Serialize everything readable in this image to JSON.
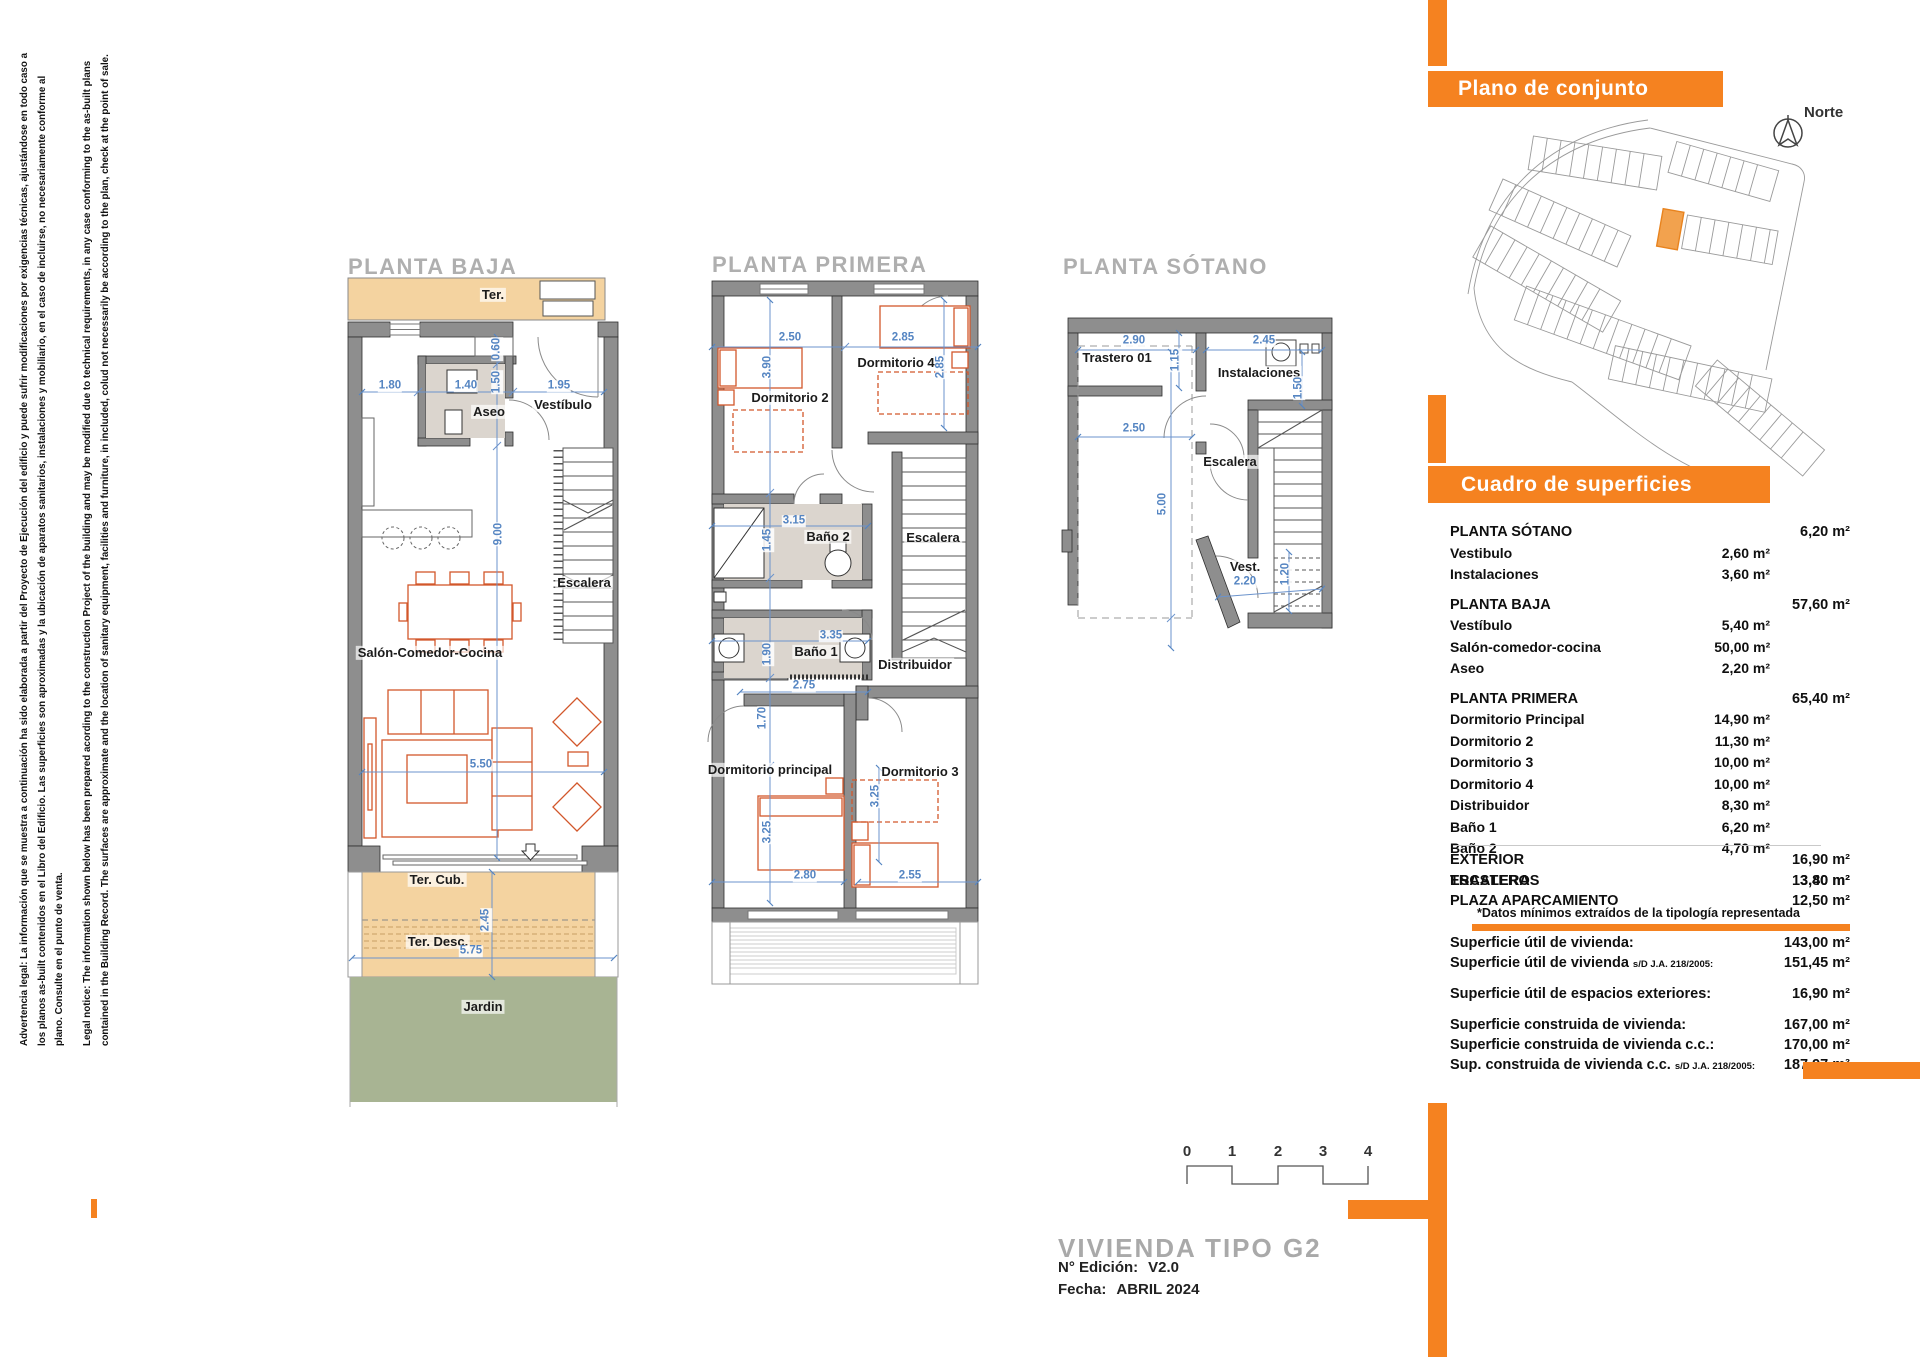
{
  "colors": {
    "accent_orange": "#F58220",
    "terrace_fill": "#F4D3A0",
    "garden_fill": "#A8B493",
    "dimension_blue": "#5585C2",
    "furniture_orange": "#D2572B",
    "wall_gray": "#8E8E8E",
    "title_gray": "#AFAFAF"
  },
  "legal": {
    "es": "Advertencia legal: La información que se muestra a continuación ha sido elaborada a partir del Proyecto de Ejecución del edificio y puede sufrir modificaciones por exigencias técnicas, ajustándose en todo caso a los planos as-built contenidos en el Libro del Edificio. Las superficies son aproximadas y la ubicación de aparatos sanitarios, instalaciones y mobiliario, en el caso de incluirse, no necesariamente conforme al plano. Consulte en el punto de venta.",
    "en": "Legal notice: The information shown below has been prepared acording to the construction Project of the building and may be modified due to technical requirements, in any case conforming to the as-built plans contained in the Building Record. The surfaces are approximate and the location of sanitary equipment, facilities and furniture, in included, colud not necessarily be according to the plan, check at the point of sale."
  },
  "site": {
    "header": "Plano de conjunto",
    "north_label": "Norte"
  },
  "surfaces": {
    "header": "Cuadro de superficies",
    "rows_main": [
      {
        "type": "group",
        "label": "PLANTA SÓTANO",
        "right": "6,20 m²"
      },
      {
        "type": "item",
        "label": "Vestibulo",
        "mid": "2,60 m²"
      },
      {
        "type": "item",
        "label": "Instalaciones",
        "mid": "3,60 m²"
      },
      {
        "type": "group",
        "label": "PLANTA BAJA",
        "right": "57,60 m²"
      },
      {
        "type": "item",
        "label": "Vestíbulo",
        "mid": "5,40 m²"
      },
      {
        "type": "item",
        "label": "Salón-comedor-cocina",
        "mid": "50,00 m²"
      },
      {
        "type": "item",
        "label": "Aseo",
        "mid": "2,20 m²"
      },
      {
        "type": "group",
        "label": "PLANTA PRIMERA",
        "right": "65,40 m²"
      },
      {
        "type": "item",
        "label": "Dormitorio Principal",
        "mid": "14,90 m²"
      },
      {
        "type": "item",
        "label": "Dormitorio 2",
        "mid": "11,30 m²"
      },
      {
        "type": "item",
        "label": "Dormitorio 3",
        "mid": "10,00 m²"
      },
      {
        "type": "item",
        "label": "Dormitorio 4",
        "mid": "10,00 m²"
      },
      {
        "type": "item",
        "label": "Distribuidor",
        "mid": "8,30 m²"
      },
      {
        "type": "item",
        "label": "Baño 1",
        "mid": "6,20 m²"
      },
      {
        "type": "item",
        "label": "Baño 2",
        "mid": "4,70 m²"
      },
      {
        "type": "total gap",
        "label": "ESCALERAS",
        "right": "13,80 m²"
      }
    ],
    "rows_exterior": [
      {
        "type": "total",
        "label": "EXTERIOR",
        "right": "16,90 m²"
      },
      {
        "type": "total",
        "label": "TRASTERO",
        "right": "3,40 m²"
      },
      {
        "type": "total",
        "label": "PLAZA APARCAMIENTO",
        "right": "12,50 m²"
      }
    ],
    "note": "*Datos mínimos extraídos de la tipología representada",
    "rows_summary": [
      {
        "type": "net",
        "label": "Superficie útil de vivienda:",
        "right": "143,00 m²"
      },
      {
        "type": "net",
        "label": "Superficie útil de vivienda",
        "suffix": "s/D J.A. 218/2005:",
        "right": "151,45 m²"
      },
      {
        "type": "net gap",
        "label": "Superficie útil de espacios exteriores:",
        "right": "16,90 m²"
      },
      {
        "type": "net gap",
        "label": "Superficie construida de vivienda:",
        "right": "167,00 m²"
      },
      {
        "type": "net",
        "label": "Superficie construida de vivienda c.c.:",
        "right": "170,00 m²"
      },
      {
        "type": "net",
        "label": "Sup. construida de vivienda c.c.",
        "suffix": "s/D J.A. 218/2005:",
        "right": "187,97 m²"
      }
    ]
  },
  "plans": {
    "baja": {
      "title": "PLANTA BAJA",
      "rooms": {
        "ter": "Ter.",
        "aseo": "Aseo",
        "vestibulo": "Vestíbulo",
        "escalera": "Escalera",
        "salon": "Salón-Comedor-Cocina",
        "ter_cub": "Ter. Cub.",
        "ter_desc": "Ter. Desc.",
        "jardin": "Jardin"
      },
      "dims": {
        "w_left": "1.80",
        "w_aseo": "1.40",
        "w_right": "1.95",
        "d_closet": "0.60",
        "d_aseo": "1.50",
        "length": "9.00",
        "width": "5.50",
        "terrace_depth": "2.45",
        "terrace_width": "5.75"
      }
    },
    "primera": {
      "title": "PLANTA PRIMERA",
      "rooms": {
        "dorm2": "Dormitorio 2",
        "dorm4": "Dormitorio 4",
        "bano2": "Baño 2",
        "escalera": "Escalera",
        "bano1": "Baño 1",
        "distribuidor": "Distribuidor",
        "dorm_ppal": "Dormitorio principal",
        "dorm3": "Dormitorio 3"
      },
      "dims": {
        "dorm2_w": "2.50",
        "dorm4_w": "2.85",
        "dorm2_d": "3.90",
        "dorm4_d": "2.85",
        "bano2_w": "3.15",
        "bano2_d": "1.45",
        "bano1_w": "3.35",
        "bano1_d": "1.90",
        "hall_w": "2.75",
        "hall_d": "1.70",
        "ppal_d": "3.25",
        "dorm3_d": "3.25",
        "ppal_w": "2.80",
        "dorm3_w": "2.55"
      }
    },
    "sotano": {
      "title": "PLANTA SÓTANO",
      "rooms": {
        "trastero": "Trastero 01",
        "instalaciones": "Instalaciones",
        "escalera": "Escalera",
        "vest": "Vest."
      },
      "dims": {
        "trastero_w": "2.90",
        "trastero_d": "1.15",
        "inst_w": "2.45",
        "inst_d": "1.50",
        "parking_w": "2.50",
        "parking_l": "5.00",
        "vest_w": "2.20",
        "vest_d": "1.20"
      }
    }
  },
  "footer": {
    "scale_ticks": [
      "0",
      "1",
      "2",
      "3",
      "4"
    ],
    "title": "VIVIENDA TIPO  G2",
    "edition_label": "N° Edición:",
    "edition_value": "V2.0",
    "date_label": "Fecha:",
    "date_value": "ABRIL 2024"
  }
}
